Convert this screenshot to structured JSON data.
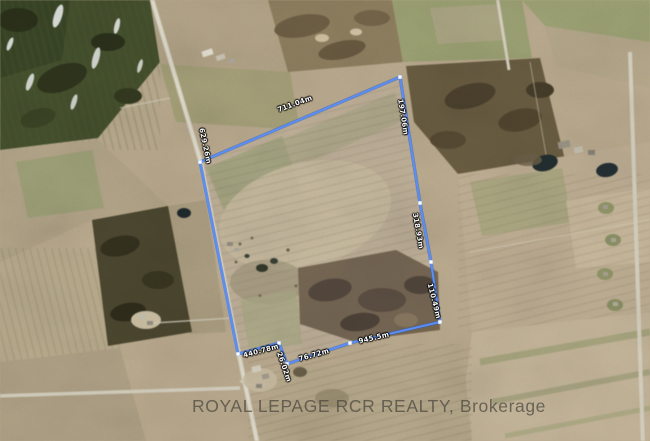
{
  "map": {
    "description": "aerial satellite photo of rural farmland parcel with surveyed boundary overlay",
    "watermark": "ROYAL LEPAGE RCR REALTY, Brokerage",
    "boundary": {
      "color": "#4a82ec",
      "vertex_color": "#ffffff",
      "measurements": {
        "top": "711.04m",
        "left": "629.26m",
        "right_upper": "197.06m",
        "right_middle": "318.93m",
        "right_lower": "110.49m",
        "bottom_left": "440.78m",
        "bottom_jog": "26.02m",
        "bottom_middle": "76.72m",
        "bottom_right": "945.5m"
      }
    }
  }
}
